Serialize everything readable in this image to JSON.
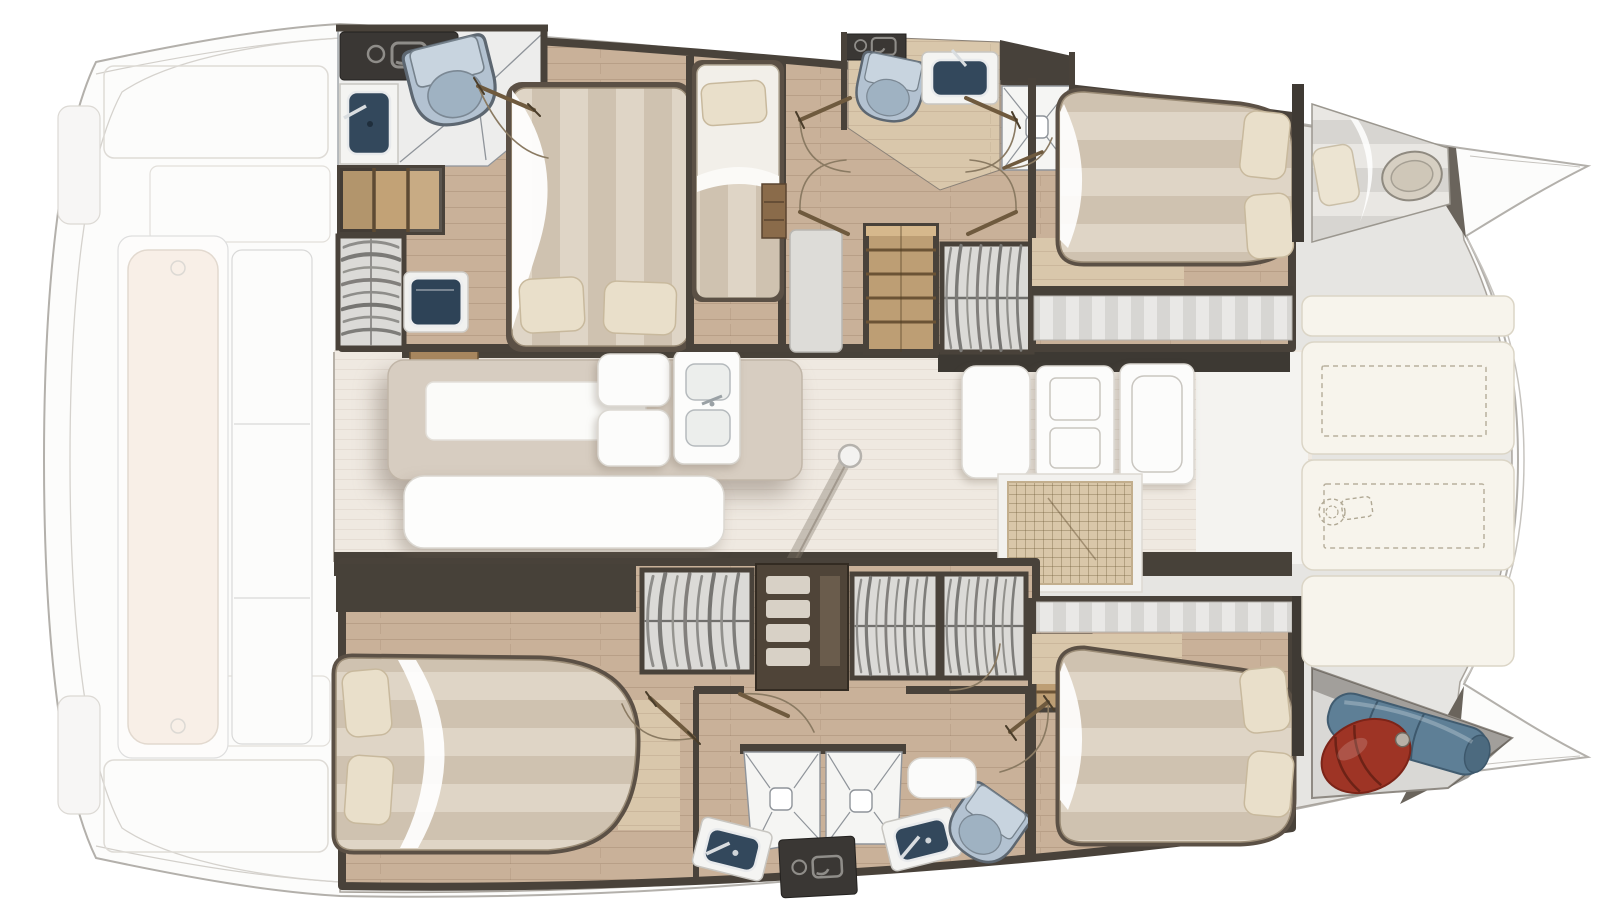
{
  "meta": {
    "title": "Catamaran interior layout — top-view floor plan",
    "canvas": {
      "width": 1600,
      "height": 920
    },
    "orientation": "bows to the right, ghosted aft deck to the left"
  },
  "palette": {
    "hull_outline": "#b3b0ab",
    "deck_gray": "#e6e5e2",
    "wood_floor": "#c9b199",
    "wood_floor_light": "#d9c7ab",
    "salon_floor": "#efe9e1",
    "wall_dark": "#474139",
    "wall_darker": "#3d3933",
    "mattress_light": "#dfd5c6",
    "mattress_dark": "#cfc2b0",
    "pillow": "#e9dfca",
    "sheet_white": "#ffffff",
    "toilet_blue": "#b3c2d1",
    "basin_navy": "#33485c",
    "counter_dark": "#3a3734",
    "table_tan": "#d7cdc1",
    "cushion_cream": "#f7f4ec",
    "steps_wood": "#bd9e74",
    "fender_red": "#9e3425",
    "bag_blue": "#5e7f96",
    "grid_mat": "#d9c7a9"
  },
  "areas": {
    "aft_deck": {
      "label": "Aft deck and cockpit (ghosted outline)"
    },
    "salon": {
      "label": "Salon with dining table, bench and galley"
    },
    "foredeck": {
      "label": "Foredeck lounge with storage hatches"
    },
    "stb_hull": {
      "label": "Upper hull: 2 double cabins, single berth, 2 heads, forepeak berth"
    },
    "port_hull": {
      "label": "Lower hull: 2 double cabins, head with twin showers, bow locker"
    }
  },
  "features": {
    "stb_aft_head": {
      "label": "Aft head: counter, washbasin, toilet, shower"
    },
    "stb_steps": {
      "label": "Companionway steps"
    },
    "stb_wardrobe": {
      "label": "Hanging wardrobe"
    },
    "stb_vanity": {
      "label": "Vanity basin unit"
    },
    "stb_aft_bed": {
      "label": "Aft cabin double berth"
    },
    "stb_single_bed": {
      "label": "Single berth cabin"
    },
    "stb_fwd_head": {
      "label": "Forward head: toilet, washbasin, shower"
    },
    "stb_stairs": {
      "label": "Stairs down into hull"
    },
    "stb_seat": {
      "label": "Seat bench"
    },
    "stb_fwd_bed": {
      "label": "Forward cabin double berth"
    },
    "stb_forepeak": {
      "label": "Forepeak berth with hatch"
    },
    "salon_table": {
      "label": "Dining table"
    },
    "salon_bench": {
      "label": "Salon bench seat"
    },
    "salon_settee": {
      "label": "Settee"
    },
    "galley_sink": {
      "label": "Galley double sink"
    },
    "galley_counters": {
      "label": "Galley counters and appliances"
    },
    "galley_mat": {
      "label": "Galley floor grating"
    },
    "mast": {
      "label": "Mast post"
    },
    "sunpads": {
      "label": "Foredeck sun pads with dashed storage hatches"
    },
    "windlass": {
      "label": "Anchor windlass (dashed symbol)"
    },
    "port_aft_bed": {
      "label": "Aft cabin double berth"
    },
    "port_wardrobes": {
      "label": "Hanging wardrobes and shelf unit"
    },
    "port_showers": {
      "label": "Twin shower stalls"
    },
    "port_sinks": {
      "label": "Twin washbasins"
    },
    "port_utility": {
      "label": "Utility counter"
    },
    "port_toilet": {
      "label": "Toilet"
    },
    "port_stairs": {
      "label": "Stairs down into hull"
    },
    "port_fwd_bed": {
      "label": "Forward cabin double berth"
    },
    "bow_locker": {
      "label": "Bow locker with red fender and rolled blue sail bag"
    }
  },
  "legend": {
    "double_berths": 4,
    "single_berths": 2,
    "toilets": 3,
    "showers": 4,
    "washbasins": 5,
    "wardrobes": 6
  }
}
